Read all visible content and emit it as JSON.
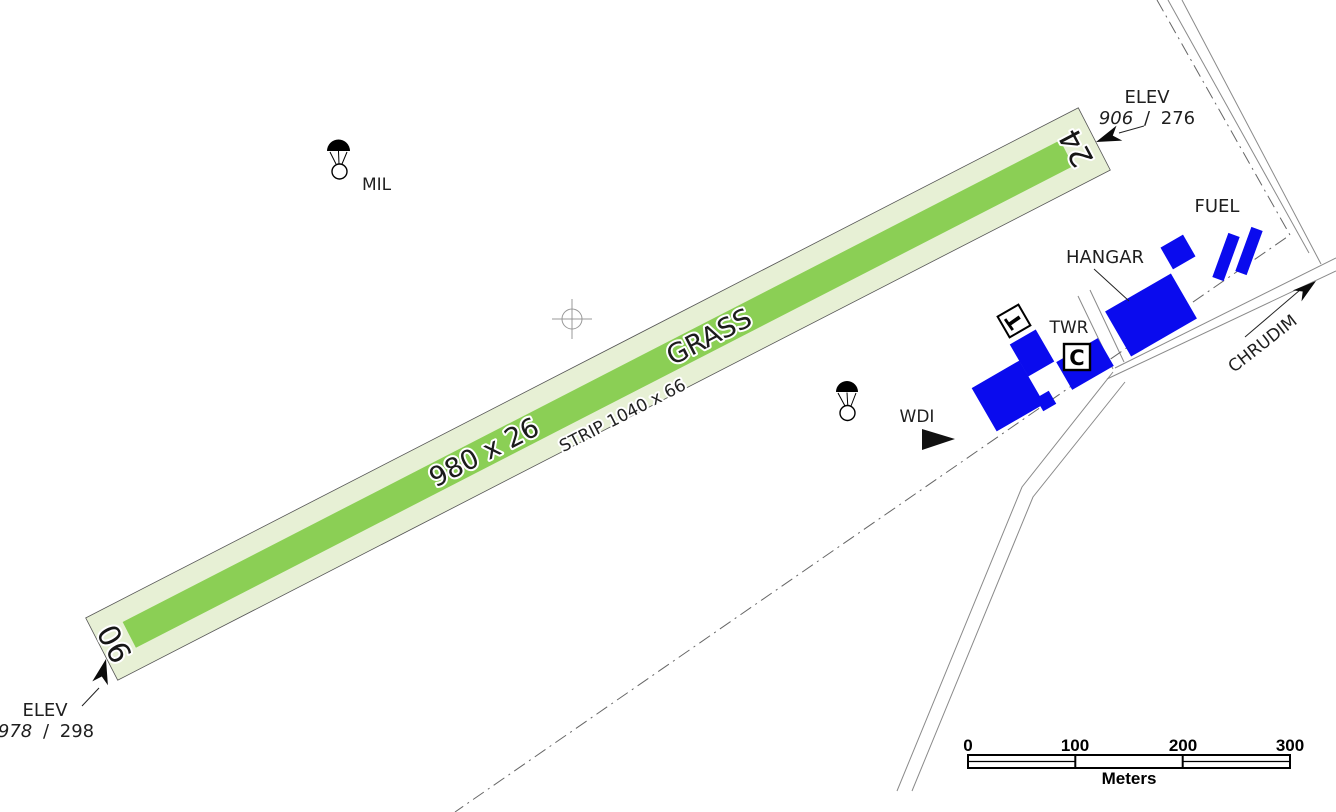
{
  "colors": {
    "strip": "#e7f0d5",
    "runway": "#8bcf55",
    "building": "#0a0bee"
  },
  "runway": {
    "designator_low": "06",
    "designator_high": "24",
    "dimensions": "980 x 26",
    "surface": "GRASS",
    "strip_label": "STRIP  1040 x 66"
  },
  "elev_high": {
    "label": "ELEV",
    "feet": "906",
    "slash": "/",
    "meters": "276"
  },
  "elev_low": {
    "label": "ELEV",
    "feet": "978",
    "slash": "/",
    "meters": "298"
  },
  "features": {
    "mil": "MIL",
    "wdi": "WDI",
    "twr": "TWR",
    "hangar": "HANGAR",
    "fuel": "FUEL",
    "t_box": "T",
    "c_box": "C",
    "chrudim": "CHRUDIM"
  },
  "scalebar": {
    "ticks": [
      "0",
      "100",
      "200",
      "300"
    ],
    "unit": "Meters"
  }
}
